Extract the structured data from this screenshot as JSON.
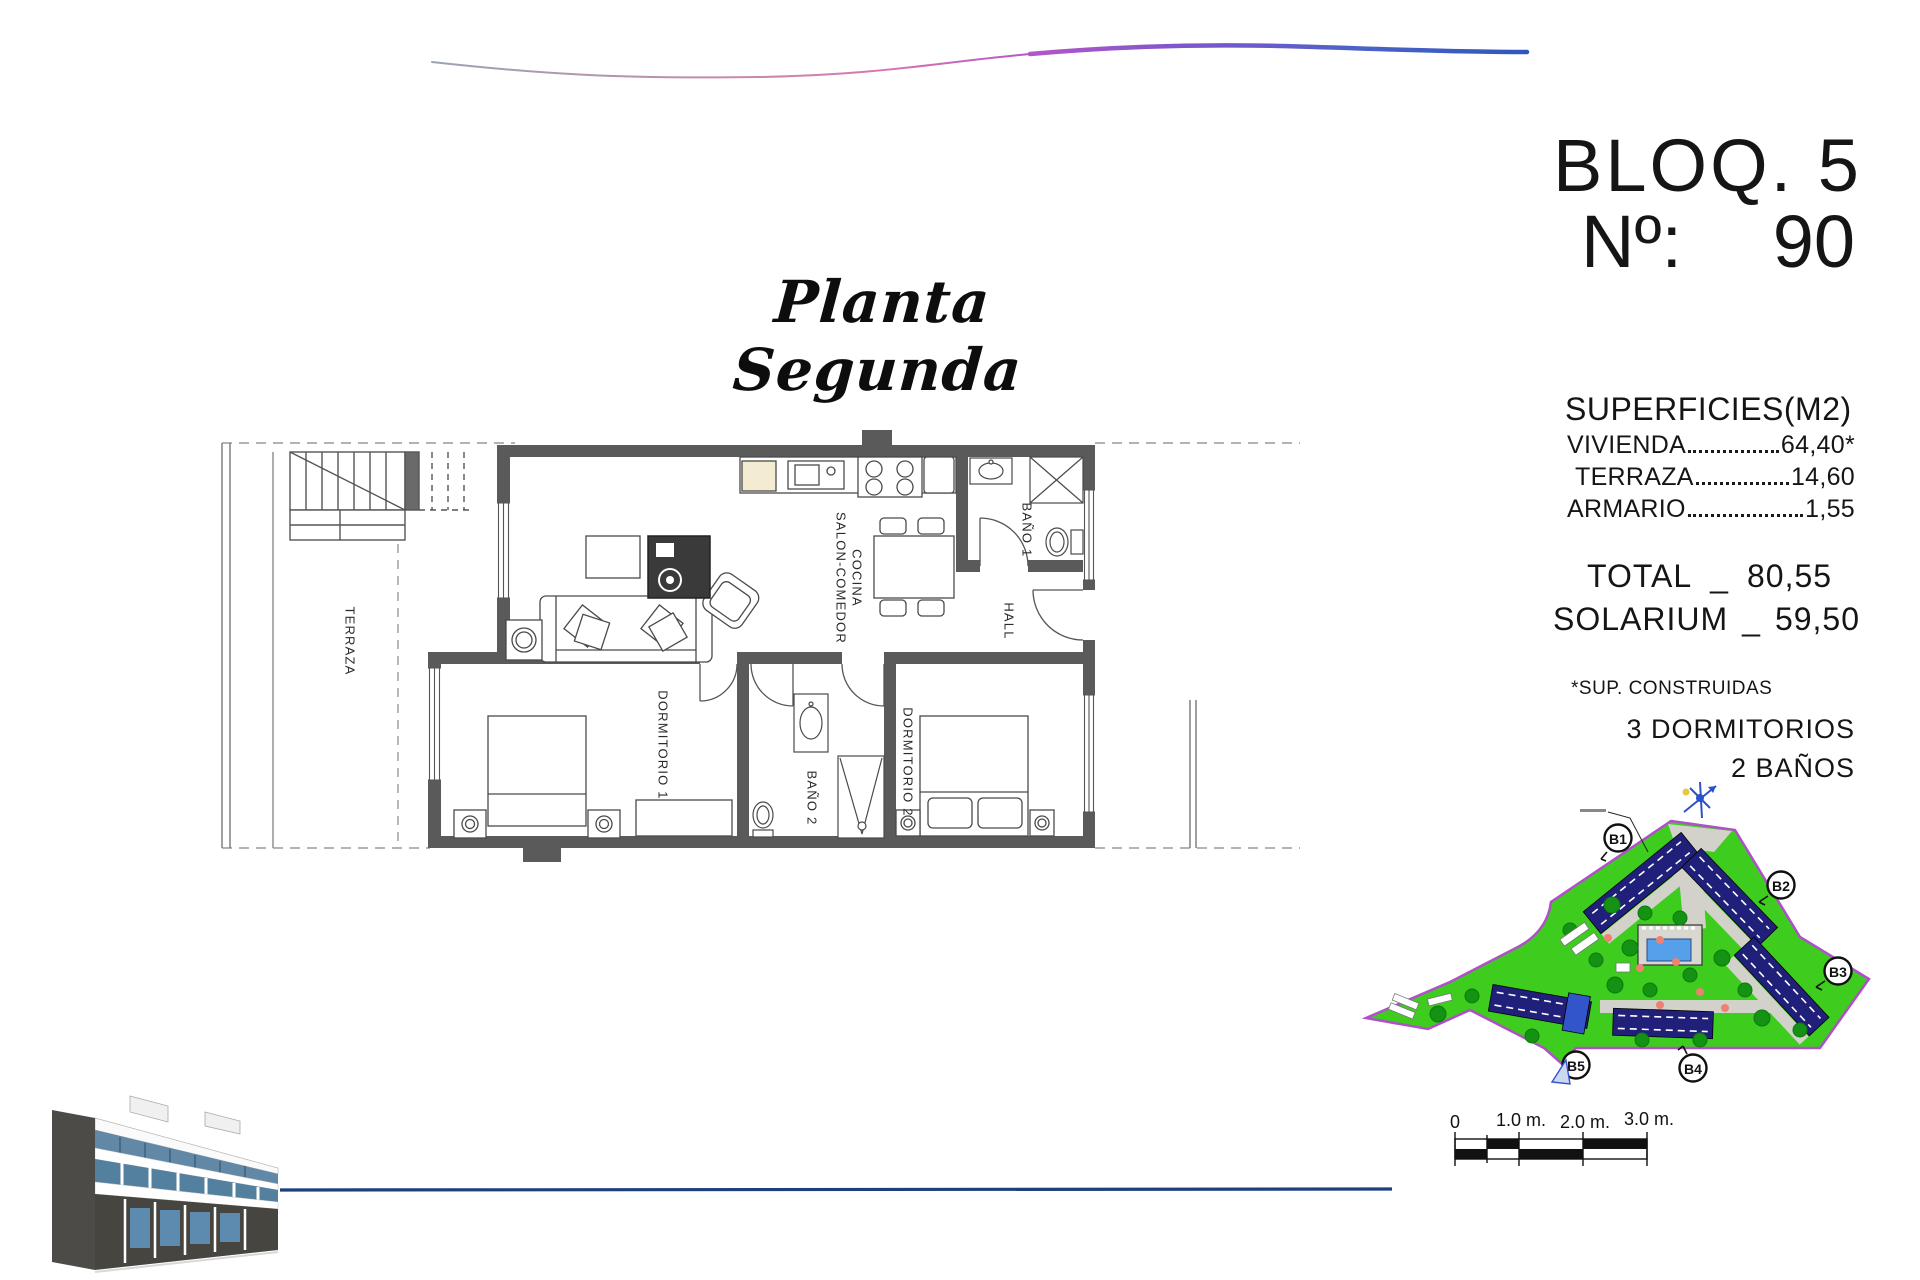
{
  "title": {
    "script_title": "Planta Segunda"
  },
  "unit_info": {
    "block": "BLOQ. 5",
    "number_label": "Nº:",
    "number": "90",
    "surfaces_heading": "SUPERFICIES(M2)",
    "rows": [
      {
        "label": "VIVIENDA",
        "value": "64,40*"
      },
      {
        "label": "TERRAZA",
        "value": "14,60"
      },
      {
        "label": "ARMARIO",
        "value": "1,55"
      }
    ],
    "total": {
      "label": "TOTAL",
      "sep": "_",
      "value": "80,55"
    },
    "solarium": {
      "label": "SOLARIUM",
      "sep": "_",
      "value": "59,50"
    },
    "footnote": "*SUP. CONSTRUIDAS",
    "bedrooms": "3 DORMITORIOS",
    "bathrooms": "2 BAÑOS"
  },
  "floor_plan": {
    "rooms": {
      "terraza": "TERRAZA",
      "salon_line1": "SALON-COMEDOR",
      "salon_line2": "COCINA",
      "bano1": "BAÑO 1",
      "hall": "HALL",
      "dorm1": "DORMITORIO 1",
      "bano2": "BAÑO 2",
      "dorm2": "DORMITORIO 2"
    }
  },
  "site_plan": {
    "blocks": [
      "B1",
      "B2",
      "B3",
      "B4",
      "B5"
    ]
  },
  "scale_bar": {
    "labels": [
      "0",
      "1.0 m.",
      "2.0 m.",
      "3.0 m."
    ]
  },
  "colors": {
    "wave_blue": "#2e57be",
    "wave_magenta": "#b455c9",
    "bottom_line_blue": "#1e3f7d",
    "site_green": "#3ecc1e",
    "site_boundary": "#b050c8",
    "building_navy": "#20207a"
  }
}
